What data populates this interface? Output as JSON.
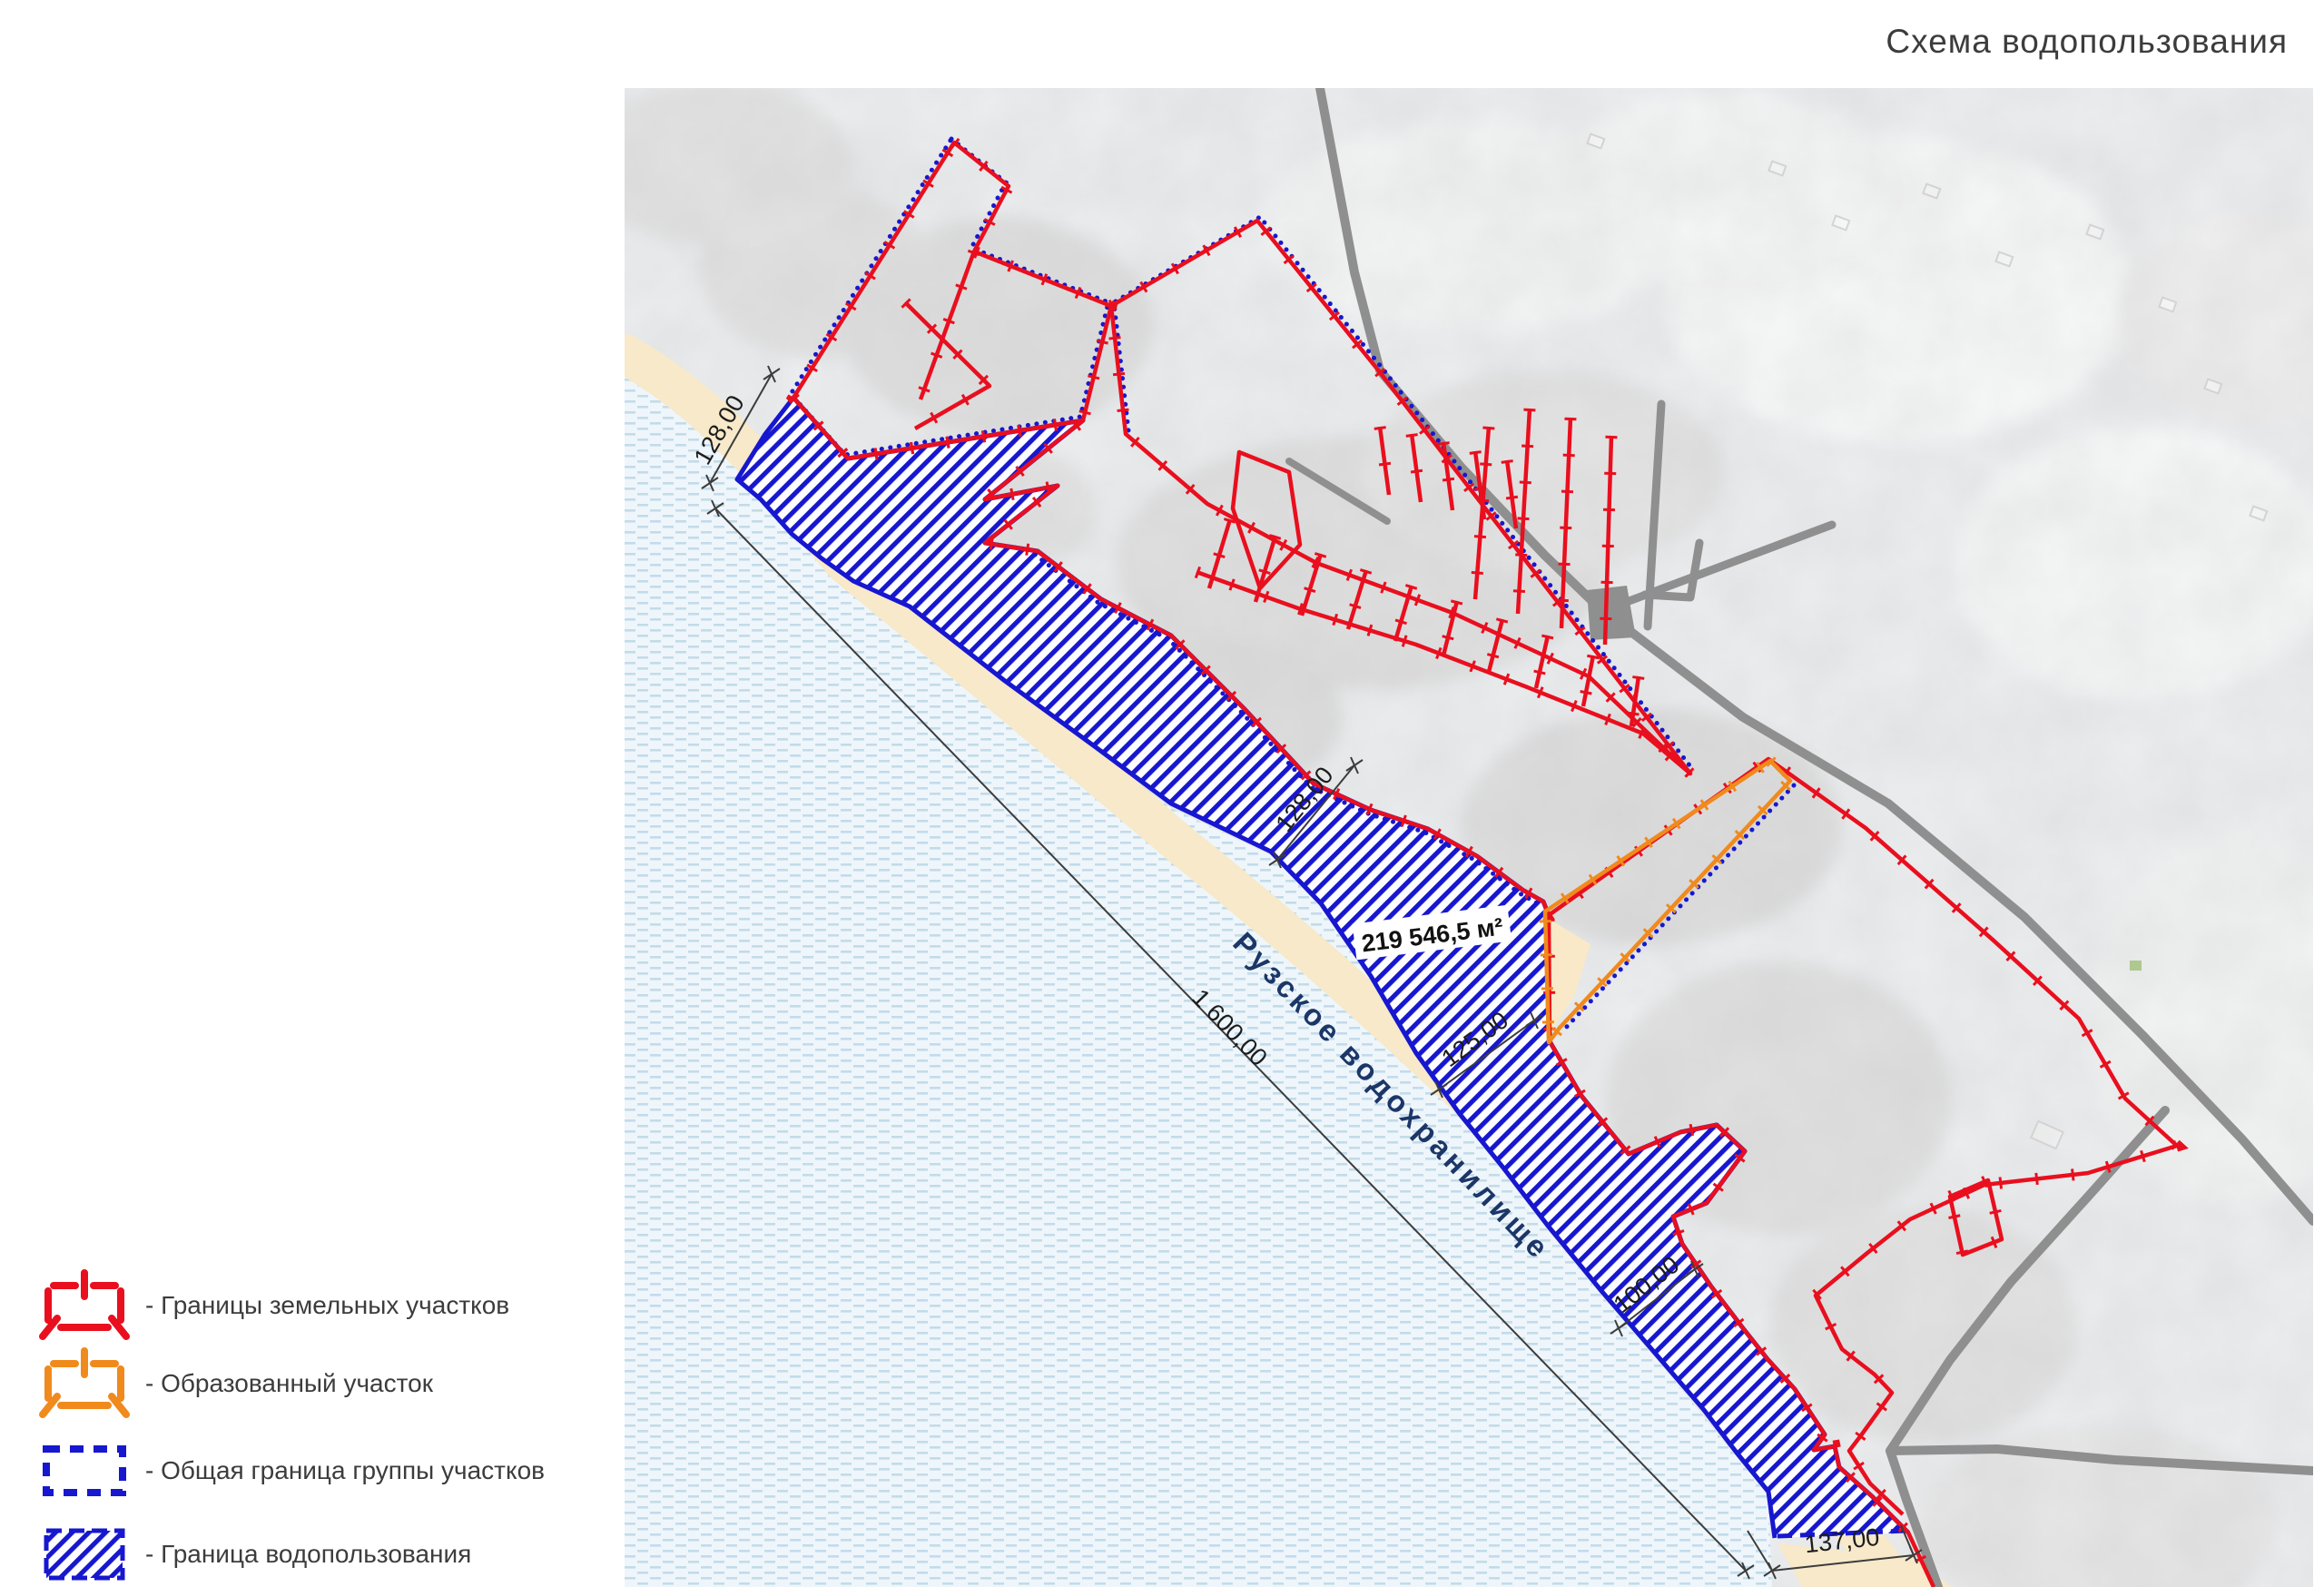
{
  "title": "Схема водопользования",
  "legend": {
    "items": [
      {
        "label": "- Границы земельных участков",
        "symbol": "red-parcel-boundary"
      },
      {
        "label": "- Образованный участок",
        "symbol": "orange-formed-parcel"
      },
      {
        "label": "- Общая граница группы участков",
        "symbol": "blue-dashed-group-boundary"
      },
      {
        "label": "- Граница водопользования",
        "symbol": "blue-hatched-water-use"
      }
    ]
  },
  "map": {
    "reservoir_label": "Рузское водохранилище",
    "area_label": "219 546,5 м²",
    "dimensions": {
      "d128_top": "128,00",
      "d1600": "1 600,00",
      "d128_mid": "128,00",
      "d125": "125,00",
      "d100": "100,00",
      "d137": "137,00"
    }
  },
  "colors": {
    "parcel_red": "#e90f1e",
    "formed_orange": "#f08a1d",
    "boundary_blue": "#1717cf",
    "reservoir_text_navy": "#1c3668",
    "road_gray": "#8f8f8f",
    "water": "#eef6fb",
    "beach": "#f7e9c9"
  }
}
